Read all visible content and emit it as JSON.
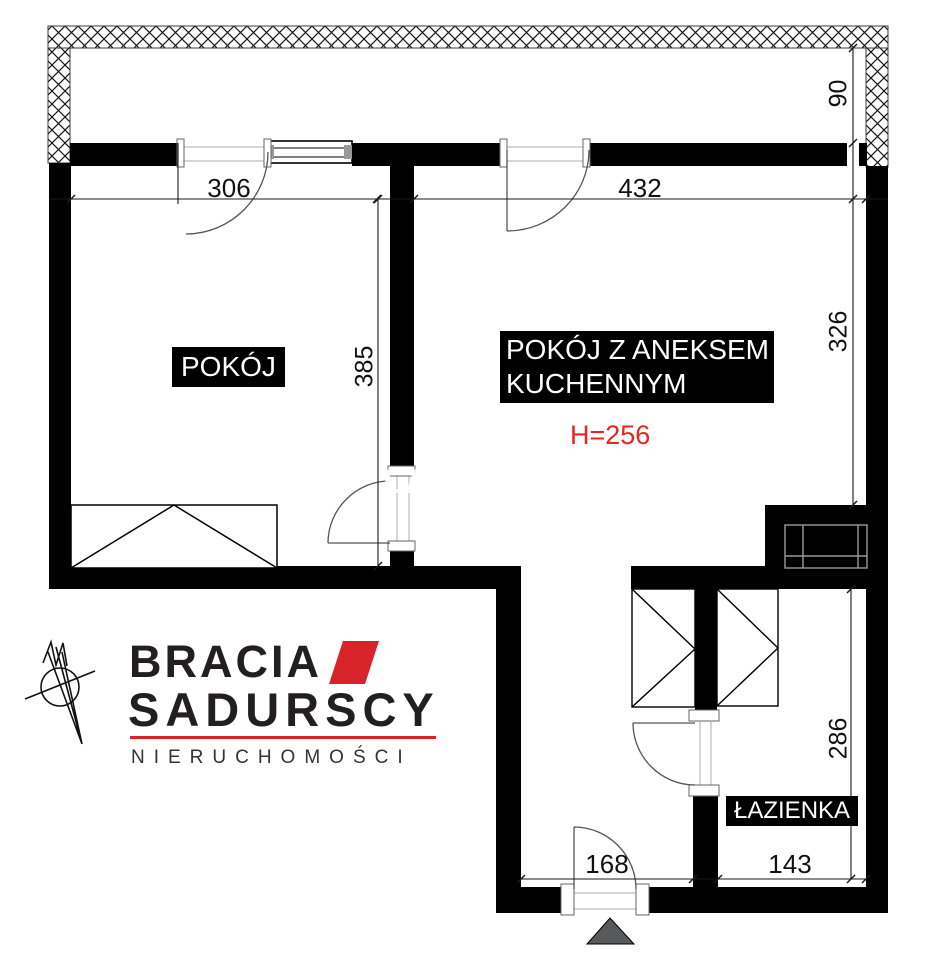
{
  "plan": {
    "room_pokoj": {
      "label": "POKÓJ"
    },
    "room_kitchen": {
      "label_line1": "POKÓJ Z ANEKSEM",
      "label_line2": "KUCHENNYM",
      "ceiling_height": "H=256"
    },
    "room_bathroom": {
      "label": "ŁAZIENKA"
    },
    "dimensions": {
      "pokoj_width": "306",
      "kitchen_width": "432",
      "balcony_depth": "90",
      "pokoj_depth": "385",
      "kitchen_depth": "326",
      "hall_width": "168",
      "bathroom_width": "143",
      "bathroom_depth": "286"
    },
    "watermark_fragment": "LA"
  },
  "branding": {
    "logo_line1": "BRACIA",
    "logo_line2": "SADURSCY",
    "logo_line3": "NIERUCHOMOŚCI"
  },
  "icons": {
    "north_arrow": "compass-north-arrow",
    "entrance_marker": "entrance-triangle"
  },
  "colors": {
    "wall_black": "#000000",
    "brand_red": "#d8232a",
    "height_label_red": "#e8251f",
    "entrance_gray": "#58595b"
  }
}
